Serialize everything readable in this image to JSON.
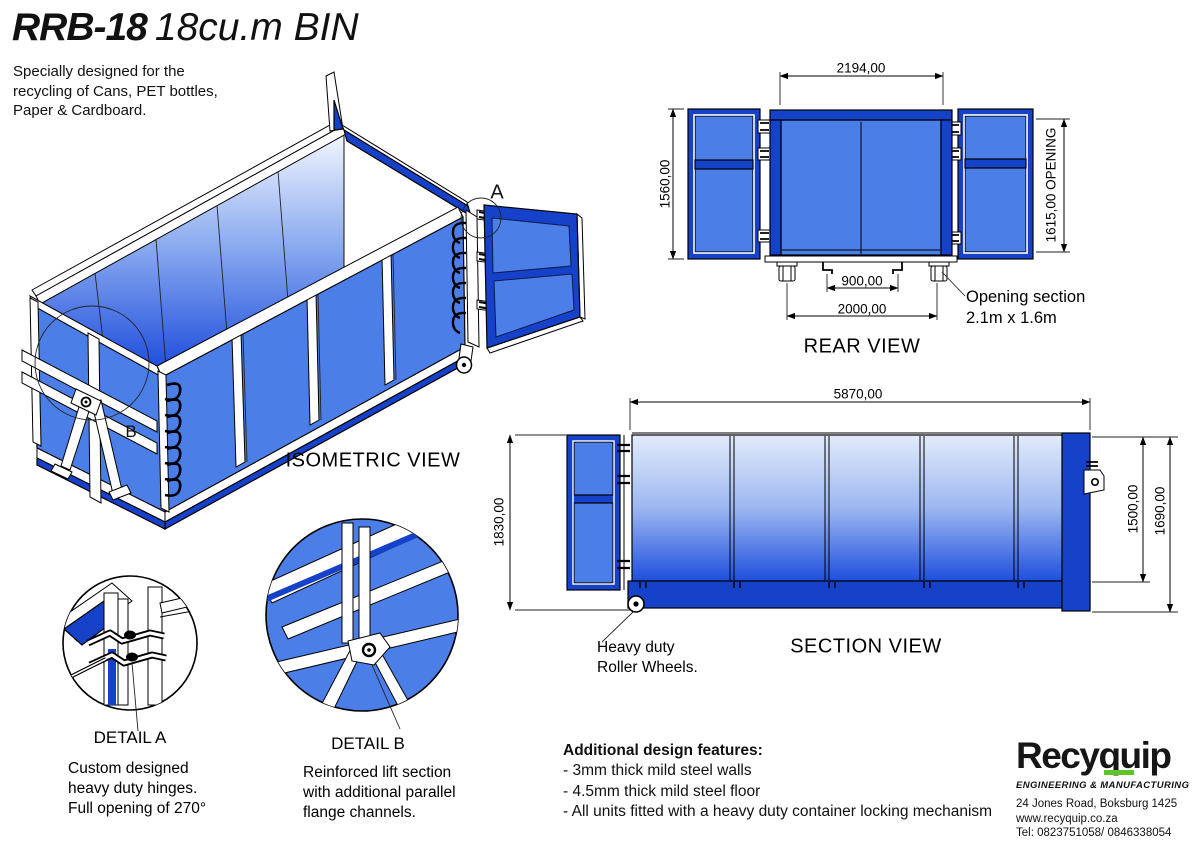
{
  "title": {
    "model": "RRB-18",
    "name": "18cu.m BIN",
    "description_lines": [
      "Specially designed for the",
      "recycling of Cans, PET bottles,",
      "Paper & Cardboard."
    ]
  },
  "isometric": {
    "label": "ISOMETRIC VIEW",
    "marker_a": "A",
    "marker_b": "B"
  },
  "rear_view": {
    "label": "REAR VIEW",
    "dim_top": "2194,00",
    "dim_left": "1560,00",
    "dim_right": "1615,00 OPENING",
    "dim_inner": "900,00",
    "dim_outer": "2000,00",
    "callout_lines": [
      "Opening section",
      "2.1m x 1.6m"
    ]
  },
  "section_view": {
    "label": "SECTION VIEW",
    "dim_top": "5870,00",
    "dim_left": "1830,00",
    "dim_right_inner": "1500,00",
    "dim_right_outer": "1690,00",
    "callout_lines": [
      "Heavy duty",
      "Roller Wheels."
    ]
  },
  "detail_a": {
    "label": "DETAIL A",
    "lines": [
      "Custom designed",
      "heavy duty hinges.",
      "Full opening of 270°"
    ]
  },
  "detail_b": {
    "label": "DETAIL  B",
    "lines": [
      "Reinforced lift section",
      "with additional parallel",
      "flange channels."
    ]
  },
  "features": {
    "title": "Additional design features:",
    "items": [
      "- 3mm thick mild steel walls",
      "- 4.5mm thick mild steel floor",
      "- All units fitted with a heavy duty container locking mechanism"
    ]
  },
  "brand": {
    "name": "Recyquip",
    "tagline": "ENGINEERING & MANUFACTURING",
    "address": "24 Jones Road, Boksburg 1425",
    "website": "www.recyquip.co.za",
    "phone": "Tel: 0823751058/ 0846338054"
  },
  "colors": {
    "frame_blue": "#1641C9",
    "panel_blue": "#4C7EE8",
    "accent_green": "#5BC52A",
    "background": "#FFFFFF"
  }
}
